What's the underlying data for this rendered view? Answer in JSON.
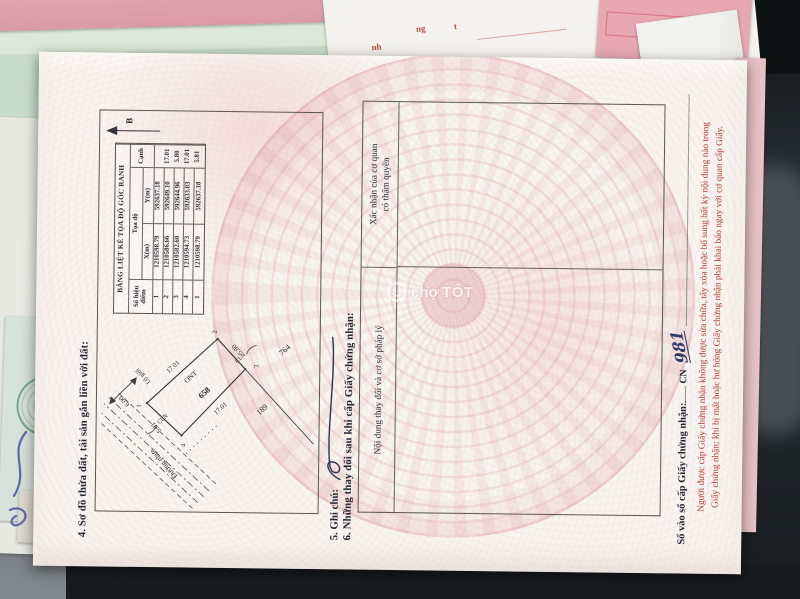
{
  "photo": {
    "brand_watermark": {
      "prefix": "chợ",
      "name": "TỐT"
    },
    "background_fragments": {
      "f1": "nh",
      "f2": "ng",
      "f3": "t"
    }
  },
  "document": {
    "section4_title": "4. Sơ đồ thửa đất, tài sản gắn liền với đất:",
    "coordinate_table": {
      "title": "BẢNG LIỆT KÊ TỌA ĐỘ GÓC RANH",
      "col_point_no": "Số hiệu điểm",
      "col_coords": "Tọa độ",
      "col_x": "X(m)",
      "col_y": "Y(m)",
      "col_edge": "Cạnh",
      "rows": [
        {
          "no": "1",
          "x": "1210598.79",
          "y": "592637.18"
        },
        {
          "no": "2",
          "x": "1210586.66",
          "y": "592649.10"
        },
        {
          "no": "3",
          "x": "1210582.60",
          "y": "592644.96"
        },
        {
          "no": "4",
          "x": "1210594.73",
          "y": "592633.03"
        },
        {
          "no": "1",
          "x": "1210598.79",
          "y": "592637.18"
        }
      ],
      "edges": [
        "17.01",
        "5.80",
        "17.01",
        "5.81"
      ]
    },
    "sketch": {
      "north_label": "B",
      "road_name": "Đường nhựa",
      "road_width": "6.00",
      "setback_label": "Lộ giới",
      "parcel_number": "658",
      "land_use_code": "ONT",
      "adjacent_code_1": "CLN",
      "adjacent_code_2": "CLN",
      "neighbor_parcel_1": "189",
      "neighbor_parcel_2": "764",
      "corners": [
        "1",
        "2",
        "3",
        "4"
      ],
      "edge_labels": [
        "17.01",
        "5.80",
        "17.01",
        "5.81"
      ]
    },
    "section5_title": "5. Ghi chú:",
    "section6_title": "6. Những thay đổi sau khi cấp Giấy chứng nhận:",
    "section6_col_left": "Nội dung thay đổi và cơ sở pháp lý",
    "section6_col_right_l1": "Xác nhận của cơ quan",
    "section6_col_right_l2": "có thẩm quyền",
    "serial_label": "Số vào sổ cấp Giấy chứng nhận:",
    "serial_prefix": "CN",
    "serial_number": "981",
    "warning_line1": "Người được cấp Giấy chứng nhận không được sửa chữa, tẩy xóa hoặc bổ sung bất kỳ nội dung nào trong",
    "warning_line2": "Giấy chứng nhận; khi bị mất hoặc hư hỏng Giấy chứng nhận phải khai báo ngay với cơ quan cấp Giấy."
  }
}
